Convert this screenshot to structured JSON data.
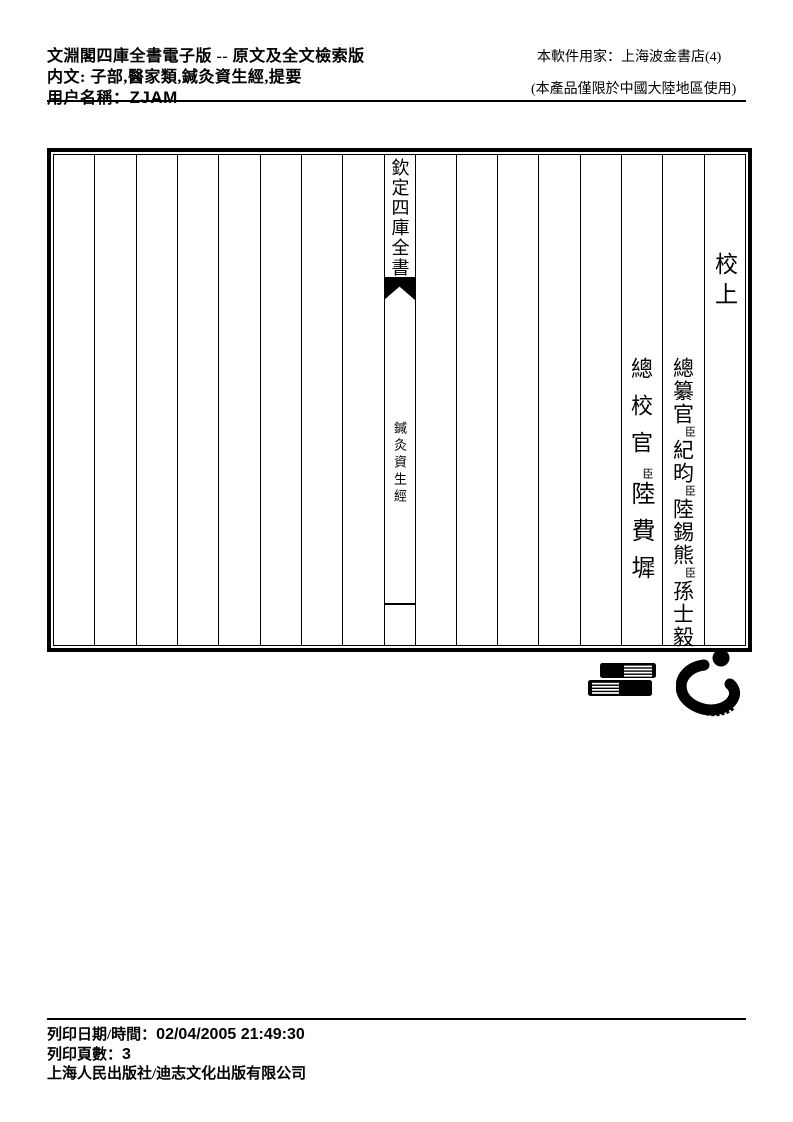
{
  "colors": {
    "ink": "#000000",
    "paper": "#ffffff"
  },
  "header": {
    "title_line": "文淵閣四庫全書電子版 -- 原文及全文檢索版",
    "content_line": "内文: 子部,醫家類,鍼灸資生經,提要",
    "user_label": "用户名稱：",
    "user_value": "ZJAM",
    "licensee_line": "本軟件用家：上海波金書店(4)",
    "restriction_line": "(本產品僅限於中國大陸地區使用)"
  },
  "book": {
    "banxin": {
      "title": "欽定四庫全書",
      "subtitle": "鍼灸資生經"
    },
    "proof_label": "校上",
    "officials": {
      "zongzuan": {
        "title": "總纂官",
        "chen1": "臣",
        "name1": "紀昀",
        "chen2": "臣",
        "name2": "陸錫熊",
        "chen3": "臣",
        "name3": "孫士毅"
      },
      "zongjiao": {
        "title": "總校官",
        "chen1": "臣",
        "name1": "陸費墀"
      }
    }
  },
  "logos": {
    "books": "stacked-books-publisher-logo",
    "swirl": "brush-swirl-publisher-logo"
  },
  "footer": {
    "datetime_label": "列印日期/時間：",
    "datetime_value": "02/04/2005 21:49:30",
    "pages_label": "列印頁數：",
    "pages_value": "3",
    "publisher_line": "上海人民出版社/迪志文化出版有限公司"
  }
}
